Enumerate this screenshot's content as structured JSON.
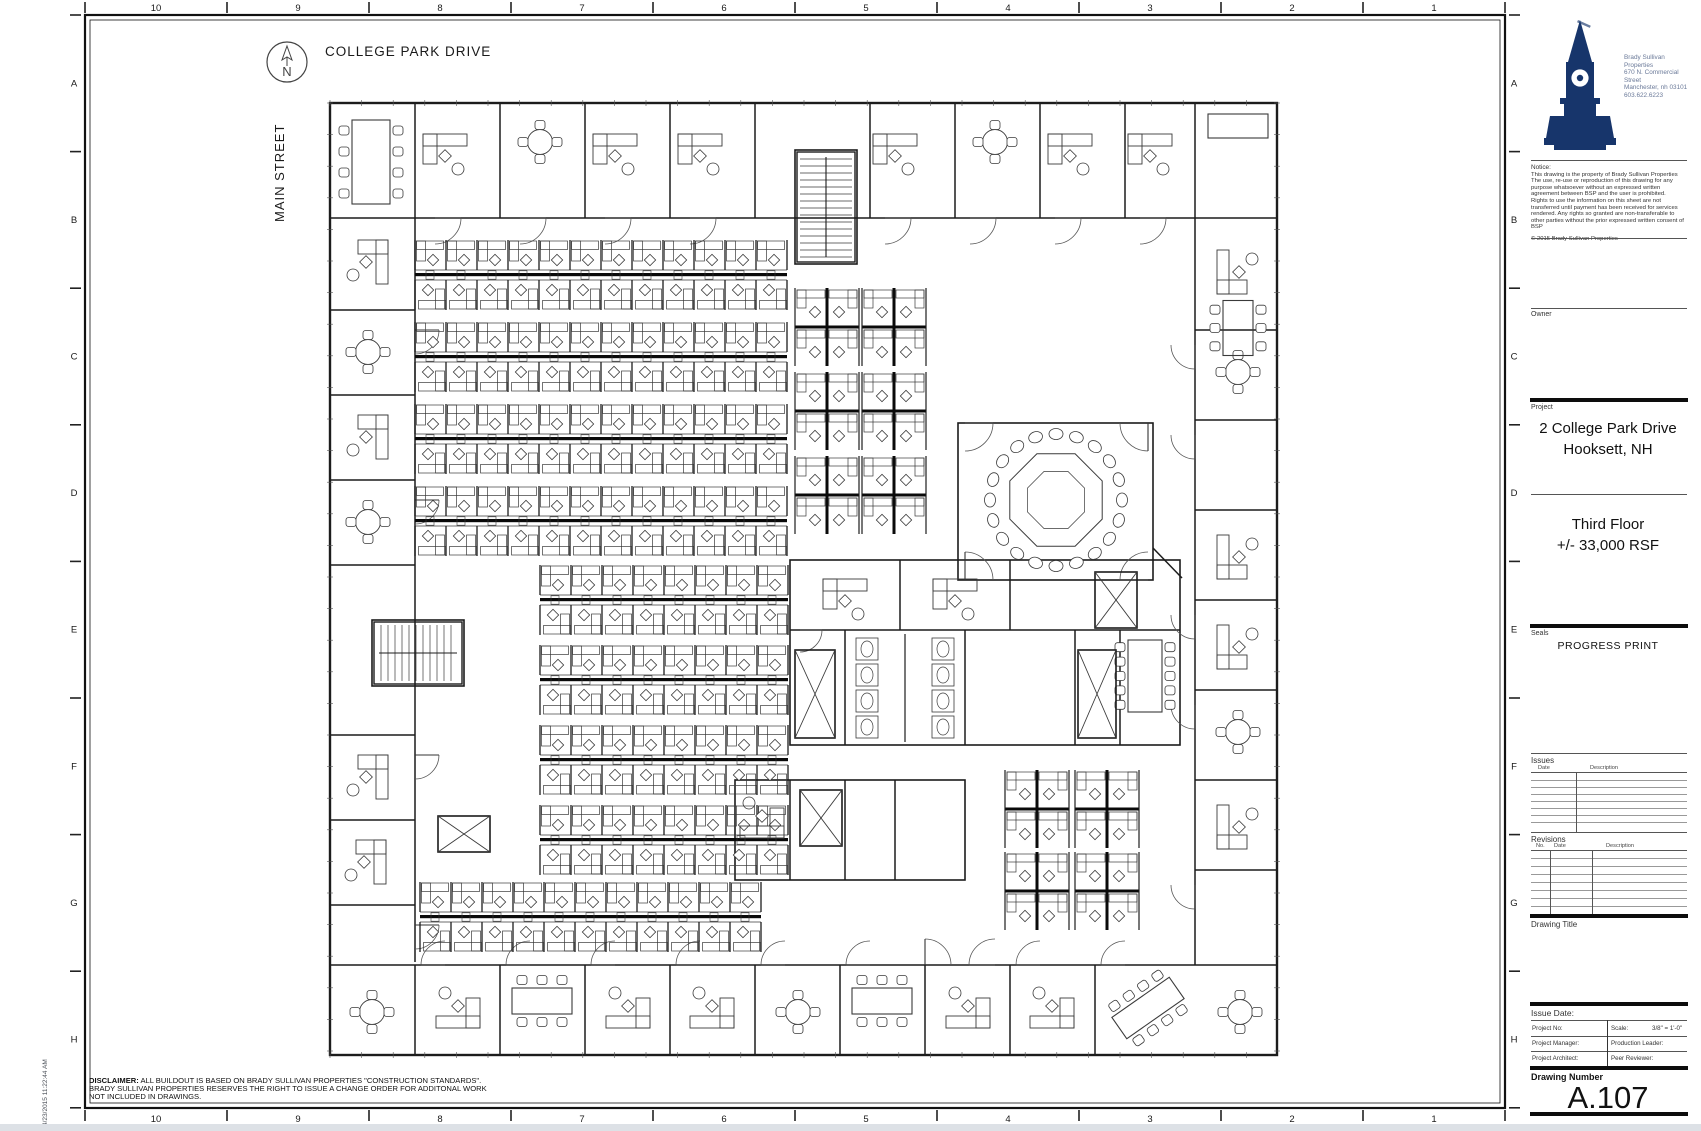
{
  "sheet": {
    "timestamp": "4/23/2015 11:22:44 AM"
  },
  "site": {
    "street_top": "COLLEGE PARK DRIVE",
    "street_left": "MAIN STREET",
    "north_label": "N"
  },
  "rulers": {
    "columns": [
      "10",
      "9",
      "8",
      "7",
      "6",
      "5",
      "4",
      "3",
      "2",
      "1"
    ],
    "rows": [
      "A",
      "B",
      "C",
      "D",
      "E",
      "F",
      "G",
      "H"
    ]
  },
  "disclaimer": {
    "label": "DISCLAIMER:",
    "line1": " ALL BUILDOUT IS BASED ON BRADY SULLIVAN PROPERTIES \"CONSTRUCTION STANDARDS\".",
    "line2": "BRADY SULLIVAN PROPERTIES RESERVES THE RIGHT TO ISSUE A CHANGE ORDER FOR ADDITONAL WORK",
    "line3": "NOT INCLUDED IN DRAWINGS."
  },
  "title_block": {
    "company": {
      "name": "Brady Sullivan Properties",
      "address1": "670 N. Commercial Street",
      "address2": "Manchester, nh 03101",
      "phone": "603.622.6223"
    },
    "notice": {
      "heading": "Notice:",
      "p1": "This drawing is the property of Brady Sullivan Properties The use, re-use or reproduction of this drawing for any purpose whatsoever without an expressed written agreement between BSP and the user is prohibited.",
      "p2": "Rights to use the  information on this sheet are not transferred until payment has been  received for services rendered. Any rights so granted are non-transferable to other parties without  the prior expressed written consent of BSP",
      "copyright": "© 2015 Brady Sullivan Properties"
    },
    "owner_label": "Owner",
    "project_label": "Project",
    "project_line1": "2 College Park Drive",
    "project_line2": "Hooksett, NH",
    "floor_line1": "Third Floor",
    "floor_line2": "+/-  33,000 RSF",
    "seals_label": "Seals",
    "progress_print": "PROGRESS PRINT",
    "issues": {
      "heading": "Issues",
      "col_date": "Date",
      "col_desc": "Description"
    },
    "revisions": {
      "heading": "Revisions",
      "col_no": "No.",
      "col_date": "Date",
      "col_desc": "Description"
    },
    "drawing_title_label": "Drawing Title",
    "issue_date_label": "Issue Date:",
    "fields": {
      "project_no": "Project No:",
      "scale_label": "Scale:",
      "scale_value": "3/8\" = 1'-0\"",
      "project_manager": "Project Manager:",
      "production_leader": "Production Leader:",
      "project_architect": "Project Architect:",
      "peer_reviewer": "Peer Reviewer:"
    },
    "drawing_number_label": "Drawing Number",
    "drawing_number": "A.107",
    "accent_color": "#17356b"
  },
  "floor_plan": {
    "outline": [
      330,
      103,
      947,
      952
    ],
    "rooms": [
      [
        795,
        150,
        62,
        114
      ],
      [
        372,
        620,
        92,
        66
      ],
      [
        958,
        423,
        195,
        157
      ],
      [
        790,
        560,
        390,
        185
      ],
      [
        735,
        780,
        230,
        100
      ]
    ],
    "walls": [
      [
        330,
        218,
        1277,
        218
      ],
      [
        415,
        103,
        415,
        218
      ],
      [
        500,
        103,
        500,
        218
      ],
      [
        585,
        103,
        585,
        218
      ],
      [
        670,
        103,
        670,
        218
      ],
      [
        755,
        103,
        755,
        218
      ],
      [
        870,
        103,
        870,
        218
      ],
      [
        955,
        103,
        955,
        218
      ],
      [
        1040,
        103,
        1040,
        218
      ],
      [
        1125,
        103,
        1125,
        218
      ],
      [
        1195,
        103,
        1195,
        218
      ],
      [
        415,
        218,
        415,
        962
      ],
      [
        330,
        310,
        415,
        310
      ],
      [
        330,
        395,
        415,
        395
      ],
      [
        330,
        480,
        415,
        480
      ],
      [
        330,
        565,
        415,
        565
      ],
      [
        330,
        735,
        415,
        735
      ],
      [
        330,
        820,
        415,
        820
      ],
      [
        330,
        905,
        415,
        905
      ],
      [
        1195,
        218,
        1195,
        965
      ],
      [
        1195,
        330,
        1277,
        330
      ],
      [
        1195,
        420,
        1277,
        420
      ],
      [
        1195,
        510,
        1277,
        510
      ],
      [
        1195,
        600,
        1277,
        600
      ],
      [
        1195,
        690,
        1277,
        690
      ],
      [
        1195,
        780,
        1277,
        780
      ],
      [
        1195,
        870,
        1277,
        870
      ],
      [
        330,
        965,
        1277,
        965
      ],
      [
        415,
        965,
        415,
        1055
      ],
      [
        500,
        965,
        500,
        1055
      ],
      [
        585,
        965,
        585,
        1055
      ],
      [
        670,
        965,
        670,
        1055
      ],
      [
        755,
        965,
        755,
        1055
      ],
      [
        840,
        965,
        840,
        1055
      ],
      [
        925,
        965,
        925,
        1055
      ],
      [
        1010,
        965,
        1010,
        1055
      ],
      [
        1095,
        965,
        1095,
        1055
      ],
      [
        790,
        630,
        1180,
        630
      ],
      [
        845,
        630,
        845,
        745
      ],
      [
        965,
        630,
        965,
        745
      ],
      [
        1075,
        630,
        1075,
        745
      ],
      [
        1120,
        630,
        1120,
        745
      ],
      [
        900,
        560,
        900,
        630
      ],
      [
        1010,
        560,
        1010,
        630
      ],
      [
        790,
        780,
        790,
        880
      ],
      [
        845,
        780,
        845,
        880
      ],
      [
        895,
        780,
        895,
        880
      ],
      [
        1153,
        548,
        1182,
        578
      ]
    ],
    "rows_h": [
      [
        415,
        240,
        12
      ],
      [
        415,
        322,
        12
      ],
      [
        415,
        404,
        12
      ],
      [
        415,
        486,
        12
      ],
      [
        540,
        565,
        8
      ],
      [
        540,
        645,
        8
      ],
      [
        540,
        725,
        8
      ],
      [
        540,
        805,
        8
      ],
      [
        420,
        882,
        11
      ]
    ],
    "quads": [
      [
        795,
        288
      ],
      [
        862,
        288
      ],
      [
        795,
        372
      ],
      [
        862,
        372
      ],
      [
        795,
        456
      ],
      [
        862,
        456
      ],
      [
        1005,
        770
      ],
      [
        1075,
        770
      ],
      [
        1005,
        852
      ],
      [
        1075,
        852
      ]
    ],
    "desks": [
      [
        445,
        152,
        0
      ],
      [
        615,
        152,
        0
      ],
      [
        700,
        152,
        0
      ],
      [
        895,
        152,
        0
      ],
      [
        1070,
        152,
        0
      ],
      [
        1150,
        152,
        0
      ],
      [
        370,
        262,
        90
      ],
      [
        370,
        437,
        90
      ],
      [
        370,
        777,
        90
      ],
      [
        368,
        862,
        90
      ],
      [
        1235,
        272,
        270
      ],
      [
        1235,
        557,
        270
      ],
      [
        1235,
        647,
        270
      ],
      [
        1235,
        827,
        270
      ],
      [
        458,
        1010,
        180
      ],
      [
        628,
        1010,
        180
      ],
      [
        712,
        1010,
        180
      ],
      [
        968,
        1010,
        180
      ],
      [
        1052,
        1010,
        180
      ],
      [
        845,
        597,
        0
      ],
      [
        955,
        597,
        0
      ],
      [
        762,
        820,
        180
      ]
    ],
    "round_tables": [
      [
        540,
        142
      ],
      [
        995,
        142
      ],
      [
        368,
        352
      ],
      [
        368,
        522
      ],
      [
        372,
        1012
      ],
      [
        798,
        1012
      ],
      [
        1238,
        372
      ],
      [
        1238,
        732
      ],
      [
        1240,
        1012
      ]
    ],
    "conf_tables": [
      [
        371,
        162,
        38,
        84,
        8,
        0
      ],
      [
        1238,
        126,
        60,
        24,
        0,
        0
      ],
      [
        1238,
        328,
        30,
        55,
        6,
        0
      ],
      [
        1145,
        676,
        34,
        72,
        10,
        0
      ],
      [
        542,
        1001,
        60,
        26,
        6,
        0
      ],
      [
        882,
        1001,
        60,
        26,
        6,
        0
      ],
      [
        1148,
        1008,
        70,
        26,
        8,
        -35
      ]
    ],
    "octagon": {
      "cx": 1056,
      "cy": 500,
      "r": 50,
      "chairs": 20
    },
    "stairs": [
      [
        797,
        152,
        58,
        110,
        "v"
      ],
      [
        374,
        622,
        88,
        62,
        "h"
      ]
    ],
    "elevators": [
      [
        438,
        816,
        52,
        36
      ],
      [
        795,
        650,
        40,
        88
      ],
      [
        1078,
        650,
        38,
        88
      ]
    ],
    "xboxes": [
      [
        1095,
        572,
        42,
        56
      ],
      [
        800,
        790,
        42,
        56
      ]
    ],
    "restroom": {
      "x": 848,
      "y": 634,
      "w": 114,
      "h": 108
    },
    "doors": [
      [
        435,
        218,
        26,
        0
      ],
      [
        520,
        218,
        26,
        0
      ],
      [
        605,
        218,
        26,
        0
      ],
      [
        690,
        218,
        26,
        0
      ],
      [
        885,
        218,
        26,
        0
      ],
      [
        970,
        218,
        26,
        0
      ],
      [
        1055,
        218,
        26,
        0
      ],
      [
        1140,
        218,
        26,
        0
      ],
      [
        415,
        330,
        24,
        0
      ],
      [
        415,
        500,
        24,
        0
      ],
      [
        415,
        755,
        24,
        0
      ],
      [
        415,
        925,
        24,
        0
      ],
      [
        1195,
        345,
        24,
        90
      ],
      [
        1195,
        435,
        24,
        90
      ],
      [
        1195,
        615,
        24,
        90
      ],
      [
        1195,
        705,
        24,
        90
      ],
      [
        1195,
        885,
        24,
        90
      ],
      [
        445,
        965,
        24,
        180
      ],
      [
        530,
        965,
        24,
        180
      ],
      [
        615,
        965,
        24,
        180
      ],
      [
        700,
        965,
        24,
        180
      ],
      [
        785,
        965,
        24,
        180
      ],
      [
        870,
        965,
        24,
        180
      ],
      [
        1040,
        965,
        24,
        180
      ],
      [
        1125,
        965,
        24,
        180
      ],
      [
        965,
        423,
        28,
        0
      ],
      [
        965,
        580,
        28,
        270
      ],
      [
        1148,
        423,
        28,
        90
      ],
      [
        1148,
        580,
        28,
        180
      ],
      [
        800,
        630,
        22,
        0
      ],
      [
        925,
        965,
        26,
        270
      ],
      [
        995,
        965,
        26,
        180
      ]
    ]
  }
}
